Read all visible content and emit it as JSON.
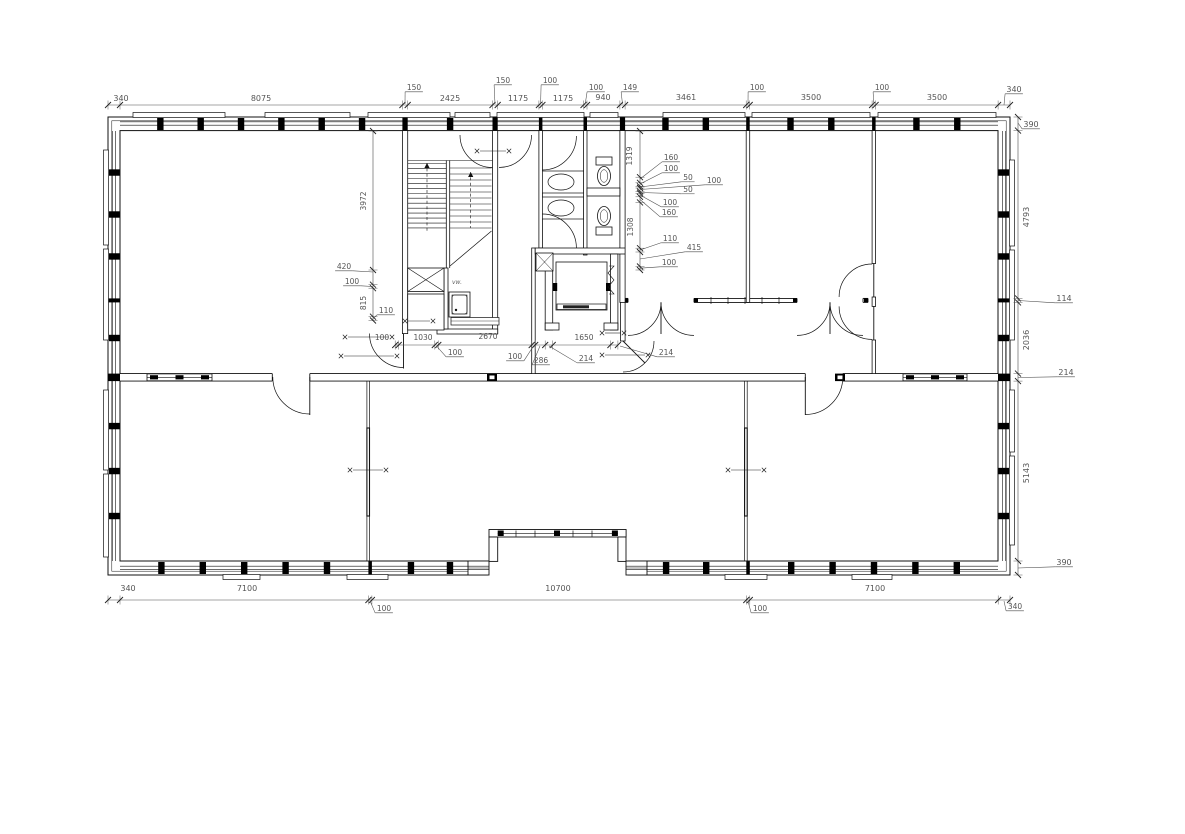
{
  "meta": {
    "drawing_type": "architectural floor plan",
    "background": "#ffffff",
    "line_color": "#111111",
    "dim_line_color": "#4a4a4a",
    "text_color": "#555555"
  },
  "labels": {
    "vw": "vw."
  },
  "dims": {
    "top_main": [
      {
        "t": "340",
        "x": 121,
        "y": 101
      },
      {
        "t": "8075",
        "x": 261,
        "y": 101
      },
      {
        "t": "2425",
        "x": 450,
        "y": 101
      },
      {
        "t": "1175",
        "x": 518,
        "y": 101
      },
      {
        "t": "1175",
        "x": 563,
        "y": 101
      },
      {
        "t": "940",
        "x": 603,
        "y": 100
      },
      {
        "t": "3461",
        "x": 686,
        "y": 100
      },
      {
        "t": "3500",
        "x": 811,
        "y": 100
      },
      {
        "t": "3500",
        "x": 937,
        "y": 100
      },
      {
        "t": "340",
        "x": 1014,
        "y": 92,
        "tx": 1004,
        "ty": 105
      }
    ],
    "top_small": [
      {
        "t": "150",
        "x": 414,
        "y": 90,
        "tx": 405,
        "ty": 104
      },
      {
        "t": "150",
        "x": 503,
        "y": 83,
        "tx": 495,
        "ty": 104
      },
      {
        "t": "100",
        "x": 550,
        "y": 83,
        "tx": 540.6,
        "ty": 104
      },
      {
        "t": "100",
        "x": 596,
        "y": 90,
        "tx": 585.2,
        "ty": 104
      },
      {
        "t": "149",
        "x": 630,
        "y": 90,
        "tx": 622.5,
        "ty": 104
      },
      {
        "t": "100",
        "x": 757,
        "y": 90,
        "tx": 748,
        "ty": 104
      },
      {
        "t": "100",
        "x": 882,
        "y": 90,
        "tx": 873.8,
        "ty": 104
      }
    ],
    "right_side": [
      {
        "t": "390",
        "x": 1031,
        "y": 127,
        "tx": 1018,
        "ty": 123
      },
      {
        "t": "4793",
        "x": 1029,
        "y": 217,
        "rot": 1
      },
      {
        "t": "114",
        "x": 1064,
        "y": 301,
        "tx": 1018,
        "ty": 300.5
      },
      {
        "t": "2036",
        "x": 1029,
        "y": 340,
        "rot": 1
      },
      {
        "t": "214",
        "x": 1066,
        "y": 375,
        "tx": 1018,
        "ty": 377.5
      },
      {
        "t": "5143",
        "x": 1029,
        "y": 473,
        "rot": 1
      },
      {
        "t": "390",
        "x": 1064,
        "y": 565,
        "tx": 1018,
        "ty": 568
      }
    ],
    "bottom_main": [
      {
        "t": "340",
        "x": 128,
        "y": 591
      },
      {
        "t": "7100",
        "x": 247,
        "y": 591
      },
      {
        "t": "10700",
        "x": 558,
        "y": 591
      },
      {
        "t": "7100",
        "x": 875,
        "y": 591
      }
    ],
    "bottom_small": [
      {
        "t": "100",
        "x": 384,
        "y": 611,
        "tx": 370.1,
        "ty": 601
      },
      {
        "t": "100",
        "x": 760,
        "y": 611,
        "tx": 748,
        "ty": 601
      },
      {
        "t": "340",
        "x": 1015,
        "y": 609,
        "tx": 1004,
        "ty": 601
      }
    ],
    "left_interior": [
      {
        "t": "3972",
        "x": 366,
        "y": 201,
        "rot": 1
      },
      {
        "t": "420",
        "x": 344,
        "y": 269,
        "tx": 373,
        "ty": 272
      },
      {
        "t": "100",
        "x": 352,
        "y": 284,
        "tx": 373,
        "ty": 286.5
      },
      {
        "t": "815",
        "x": 366,
        "y": 303,
        "rot": 1
      },
      {
        "t": "110",
        "x": 386,
        "y": 313,
        "tx": 373,
        "ty": 318.5
      }
    ],
    "center_interior": [
      {
        "t": "1319",
        "x": 632,
        "y": 156,
        "rot": 1
      },
      {
        "t": "160",
        "x": 671,
        "y": 160,
        "tx": 640,
        "ty": 179
      },
      {
        "t": "100",
        "x": 671,
        "y": 171,
        "tx": 640,
        "ty": 184
      },
      {
        "t": "50",
        "x": 688,
        "y": 180,
        "tx": 640,
        "ty": 187
      },
      {
        "t": "100",
        "x": 714,
        "y": 183,
        "tx": 640,
        "ty": 189.5
      },
      {
        "t": "50",
        "x": 688,
        "y": 192,
        "tx": 640,
        "ty": 192.5
      },
      {
        "t": "100",
        "x": 670,
        "y": 205,
        "tx": 640,
        "ty": 195
      },
      {
        "t": "160",
        "x": 669,
        "y": 215,
        "tx": 640,
        "ty": 199.5
      },
      {
        "t": "1308",
        "x": 633,
        "y": 227,
        "rot": 1
      },
      {
        "t": "110",
        "x": 670,
        "y": 241,
        "tx": 640,
        "ty": 250
      },
      {
        "t": "415",
        "x": 694,
        "y": 250,
        "tx": 640,
        "ty": 259
      },
      {
        "t": "100",
        "x": 669,
        "y": 265,
        "tx": 640,
        "ty": 268.2
      }
    ],
    "corridor_interior": [
      {
        "t": "100",
        "x": 382,
        "y": 340
      },
      {
        "t": "1030",
        "x": 423,
        "y": 340
      },
      {
        "t": "2670",
        "x": 488,
        "y": 339
      },
      {
        "t": "100",
        "x": 455,
        "y": 355,
        "tx": 436.5,
        "ty": 346
      },
      {
        "t": "100",
        "x": 515,
        "y": 359,
        "tx": 533.5,
        "ty": 346
      },
      {
        "t": "286",
        "x": 541,
        "y": 363,
        "tx": 540,
        "ty": 346
      },
      {
        "t": "214",
        "x": 586,
        "y": 361,
        "tx": 549,
        "ty": 346
      },
      {
        "t": "1650",
        "x": 584,
        "y": 340
      },
      {
        "t": "214",
        "x": 666,
        "y": 355,
        "tx": 620,
        "ty": 346
      }
    ]
  }
}
